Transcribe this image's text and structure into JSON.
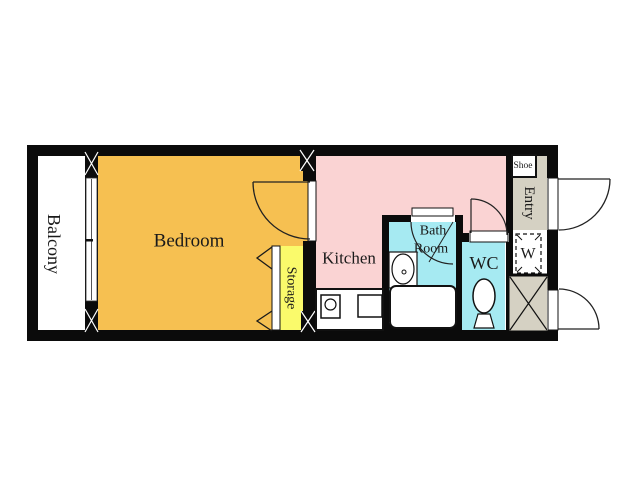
{
  "plan": {
    "title": "1K apartment floor plan",
    "rooms": {
      "balcony": {
        "label": "Balcony"
      },
      "bedroom": {
        "label": "Bedroom"
      },
      "storage": {
        "label": "Storage"
      },
      "kitchen": {
        "label": "Kitchen"
      },
      "bathroom": {
        "label_line1": "Bath",
        "label_line2": "Room"
      },
      "wc": {
        "label": "WC"
      },
      "entry": {
        "label": "Entry"
      },
      "shoe_cabinet": {
        "label": "Shoe"
      },
      "washer_space": {
        "label": "W"
      }
    },
    "colors": {
      "wall": "#0b0b0b",
      "bedroom": "#f6c051",
      "kitchen": "#fad3d3",
      "bathroom": "#a6eaf2",
      "wc": "#a6eaf2",
      "storage": "#fafa6b",
      "entry": "#d5d1c3",
      "background": "#ffffff"
    }
  }
}
